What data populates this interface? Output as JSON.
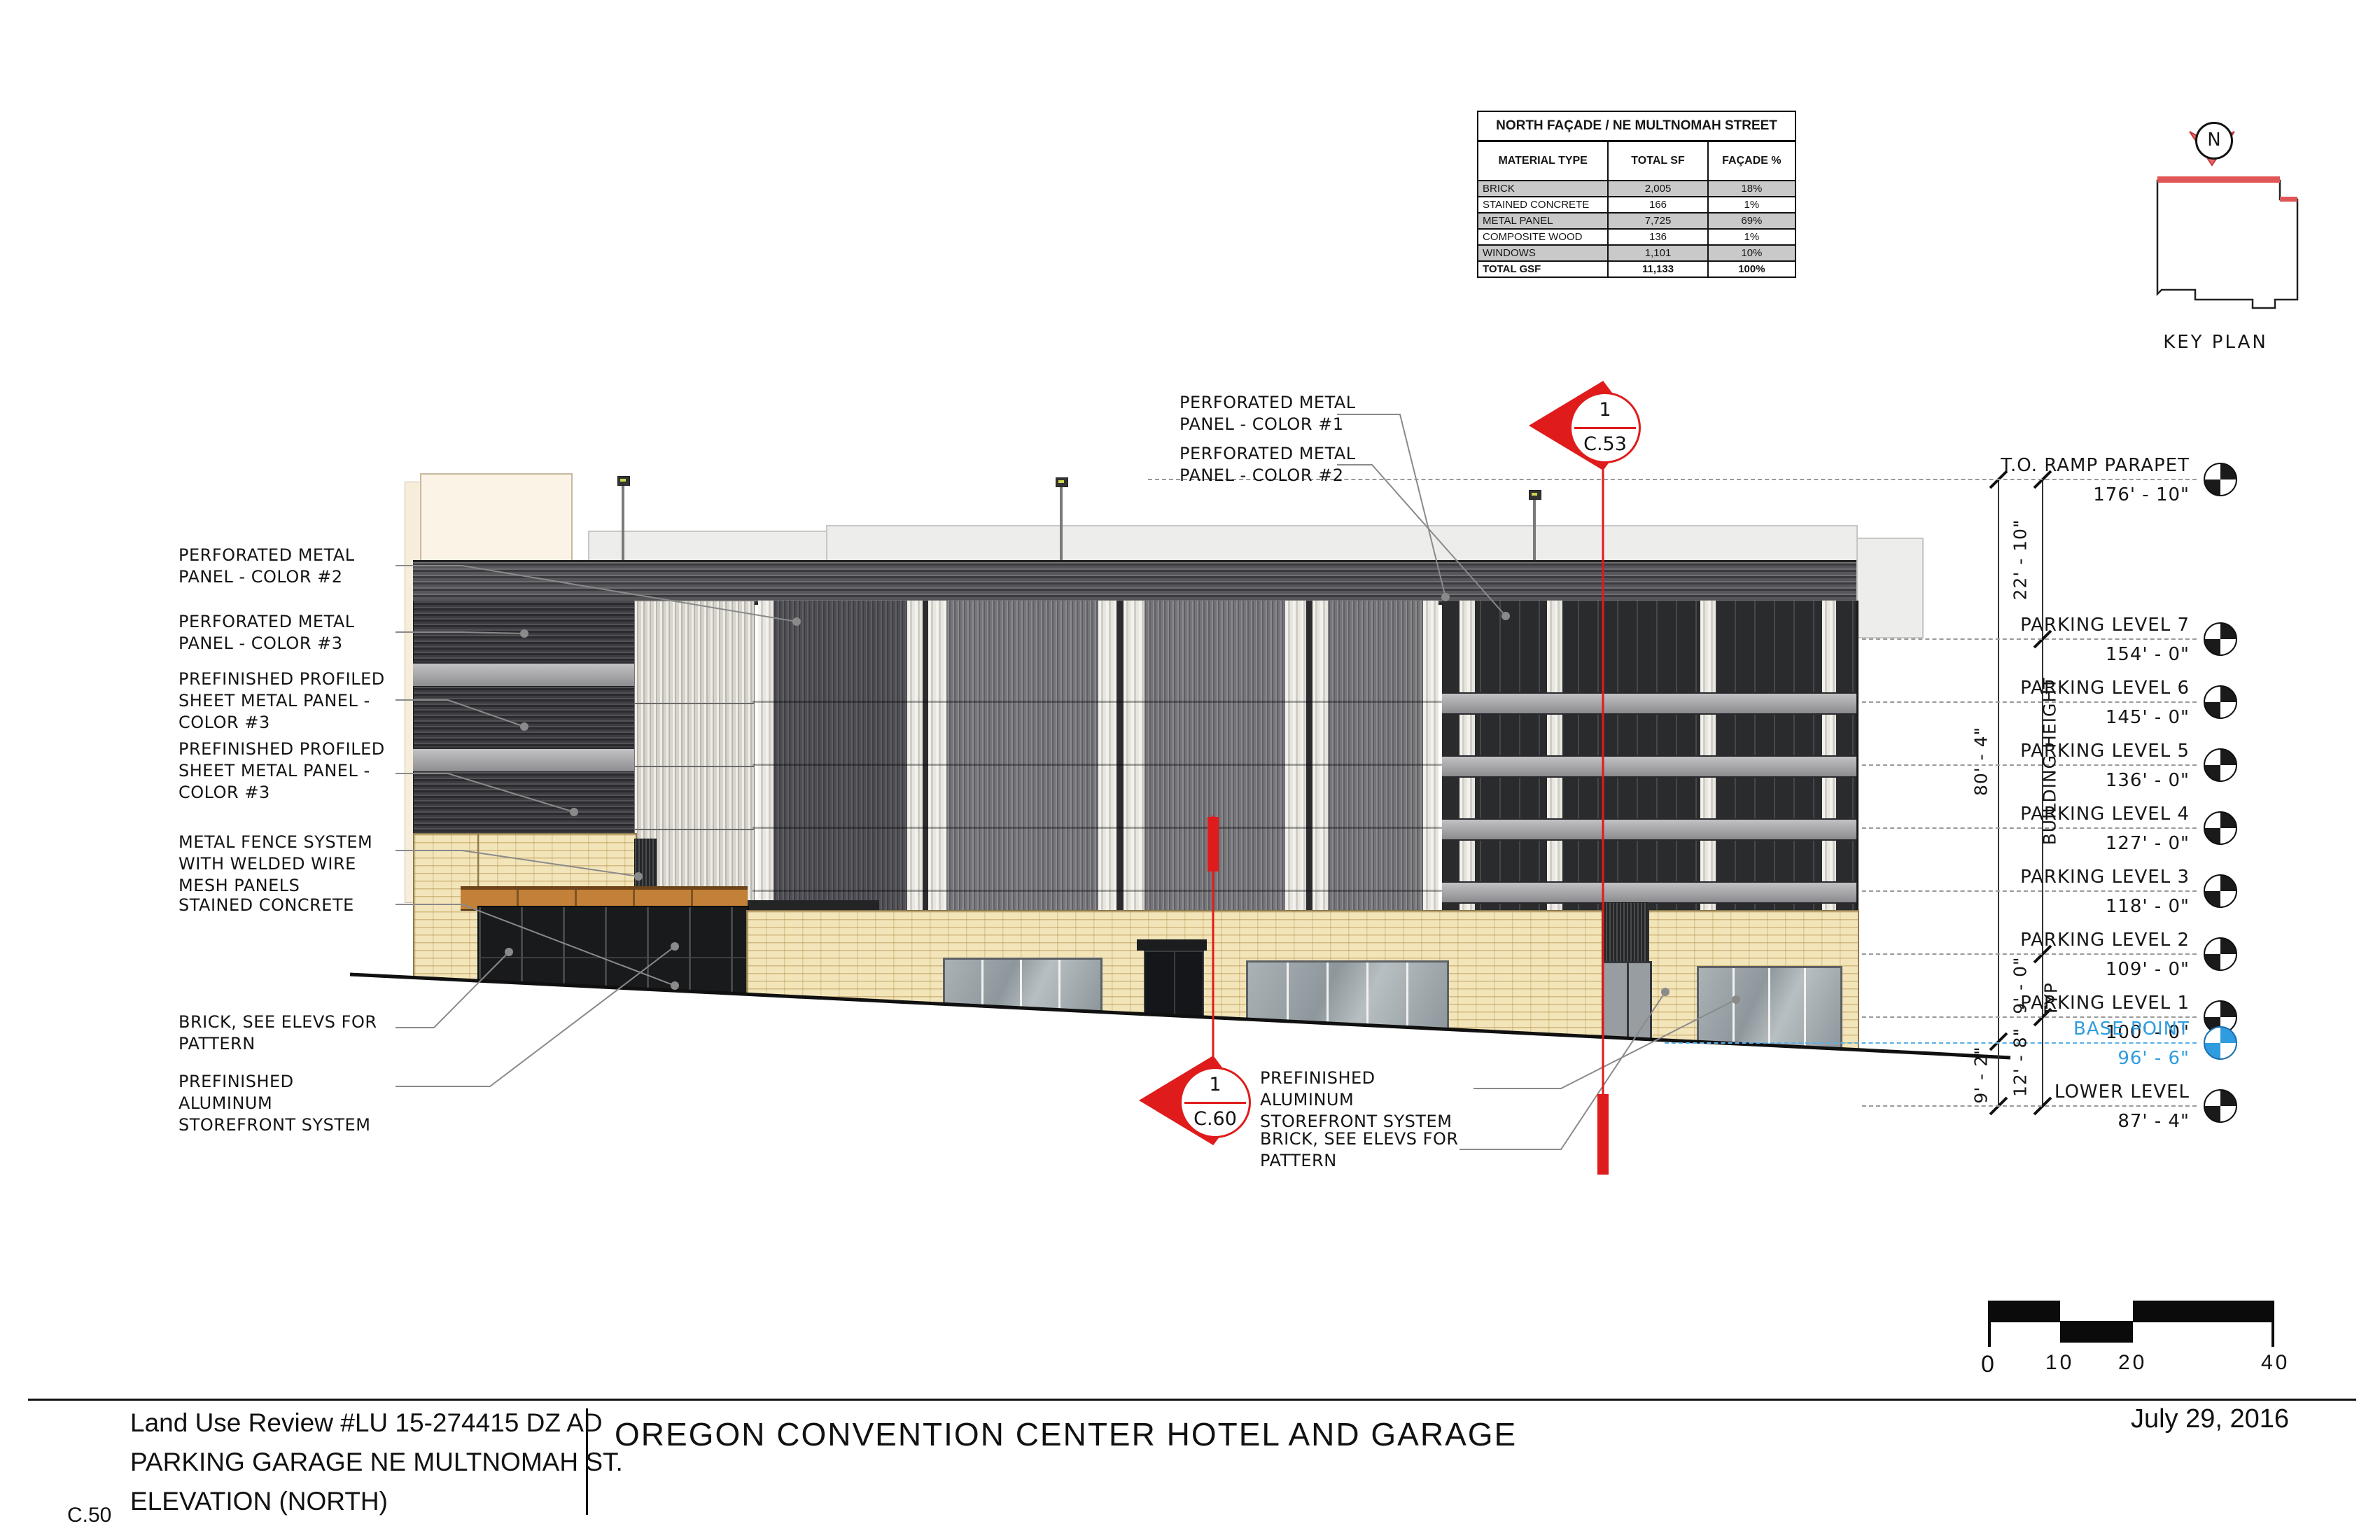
{
  "sheet": {
    "number": "C.50",
    "date": "July 29, 2016",
    "project_title": "OREGON CONVENTION CENTER HOTEL AND GARAGE",
    "review_title": "Land Use Review #LU 15-274415 DZ AD",
    "review_subtitle": "PARKING GARAGE NE MULTNOMAH ST.",
    "review_view": "ELEVATION (NORTH)"
  },
  "materials_table": {
    "title": "NORTH FAÇADE / NE MULTNOMAH STREET",
    "columns": [
      "MATERIAL TYPE",
      "TOTAL SF",
      "FAÇADE %"
    ],
    "rows": [
      [
        "BRICK",
        "2,005",
        "18%"
      ],
      [
        "STAINED CONCRETE",
        "166",
        "1%"
      ],
      [
        "METAL PANEL",
        "7,725",
        "69%"
      ],
      [
        "COMPOSITE WOOD",
        "136",
        "1%"
      ],
      [
        "WINDOWS",
        "1,101",
        "10%"
      ]
    ],
    "total_row": [
      "TOTAL GSF",
      "11,133",
      "100%"
    ]
  },
  "key_plan": {
    "label": "KEY PLAN",
    "north_label": "N"
  },
  "levels": [
    {
      "name": "T.O. RAMP PARAPET",
      "elevation": "176' - 10\""
    },
    {
      "name": "PARKING LEVEL 7",
      "elevation": "154' - 0\""
    },
    {
      "name": "PARKING LEVEL 6",
      "elevation": "145' - 0\""
    },
    {
      "name": "PARKING LEVEL 5",
      "elevation": "136' - 0\""
    },
    {
      "name": "PARKING LEVEL 4",
      "elevation": "127' - 0\""
    },
    {
      "name": "PARKING LEVEL 3",
      "elevation": "118' - 0\""
    },
    {
      "name": "PARKING LEVEL 2",
      "elevation": "109' - 0\""
    },
    {
      "name": "PARKING LEVEL 1",
      "elevation": "100' - 0\""
    },
    {
      "name": "BASE POINT",
      "elevation": "96' - 6\""
    },
    {
      "name": "LOWER LEVEL",
      "elevation": "87' - 4\""
    }
  ],
  "dimensions": {
    "parapet_to_l7": "22' - 10\"",
    "building_height_value": "80' - 4\"",
    "building_height_label": "BUILDING HEIGHT",
    "typical_floor": "9' - 0\"",
    "typical_label": "TYP",
    "l1_to_lower": "12' - 8\"",
    "base_to_lower": "9' - 2\""
  },
  "annotations": {
    "left": [
      "PERFORATED METAL PANEL - COLOR #2",
      "PERFORATED METAL PANEL - COLOR #3",
      "PREFINISHED PROFILED SHEET METAL PANEL - COLOR #3",
      "PREFINISHED PROFILED SHEET METAL PANEL - COLOR #3",
      "METAL FENCE SYSTEM WITH WELDED WIRE MESH PANELS",
      "STAINED CONCRETE",
      "BRICK, SEE ELEVS FOR PATTERN",
      "PREFINISHED ALUMINUM STOREFRONT SYSTEM"
    ],
    "top": [
      "PERFORATED METAL PANEL - COLOR #1",
      "PERFORATED METAL PANEL - COLOR #2"
    ],
    "bottom": [
      "PREFINISHED ALUMINUM STOREFRONT SYSTEM",
      "BRICK, SEE ELEVS FOR PATTERN"
    ]
  },
  "section_markers": [
    {
      "number": "1",
      "sheet": "C.53"
    },
    {
      "number": "1",
      "sheet": "C.60"
    }
  ],
  "scale_bar": {
    "labels": [
      "0",
      "10",
      "20",
      "40"
    ]
  },
  "colors": {
    "section_red": "#e01b1b",
    "base_point_blue": "#2f9ce0",
    "brick": "#f3e5ba",
    "canopy_wood": "#c28038"
  }
}
